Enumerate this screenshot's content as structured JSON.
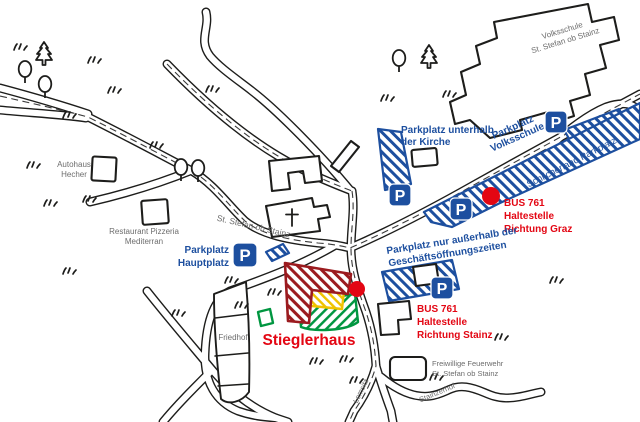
{
  "labels": {
    "volksschule_building": {
      "line1": "Volksschule",
      "line2": "St. Stefan ob Stainz"
    },
    "parkplatz_kirche": {
      "line1": "Parkplatz unterhalb",
      "line2": "der Kirche"
    },
    "parkplatz_volksschule": {
      "line1": "Parkplatz",
      "line2": "Volksschule"
    },
    "schilcherland": "Schilcherland Parkplatz",
    "bus_graz": {
      "line1": "BUS 761",
      "line2": "Haltestelle",
      "line3": "Richtung Graz"
    },
    "parkplatz_geschaeft": {
      "line1": "Parkplatz nur außerhalb der",
      "line2": "Geschäftsöffnungszeiten"
    },
    "bus_stainz": {
      "line1": "BUS 761",
      "line2": "Haltestelle",
      "line3": "Richtung Stainz"
    },
    "parkplatz_hauptplatz": {
      "line1": "Parkplatz",
      "line2": "Hauptplatz"
    },
    "street_main": "St. Stefan ob Stainz",
    "autohaus": {
      "line1": "Autohaus",
      "line2": "Hecher"
    },
    "restaurant": {
      "line1": "Restaurant Pizzeria",
      "line2": "Mediterran"
    },
    "friedhof": "Friedhof",
    "feuerwehr": {
      "line1": "Freiwillige Feuerwehr",
      "line2": "St. Stefan ob Stainz"
    },
    "lemsitz": "Lemsitz",
    "stainzerhof": "Stainzerhof",
    "stieglerhaus": "Stieglerhaus",
    "parking_sign": "P"
  },
  "colors": {
    "parking_blue": "#1d4f9f",
    "bus_red": "#e30613",
    "stieglerhaus_maroon": "#9b1b1f",
    "stieglerhaus_yellow": "#f0c300",
    "stieglerhaus_green": "#009640",
    "label_gray": "#6d6d6d",
    "line_black": "#1d1d1b",
    "background": "#ffffff"
  }
}
